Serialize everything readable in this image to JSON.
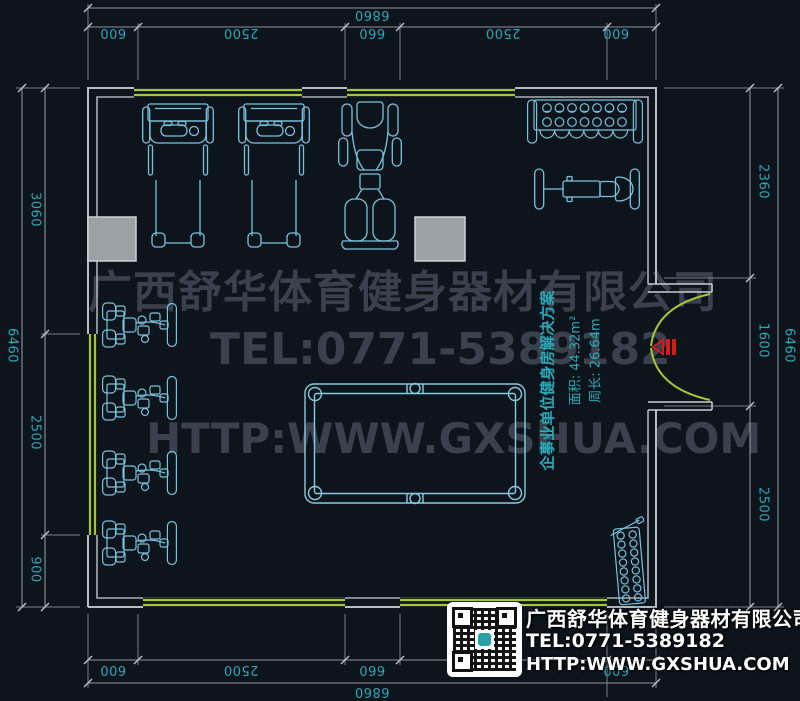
{
  "colors": {
    "background": "#0d141c",
    "wall_line": "#b5bcc2",
    "window_line": "#a3c63a",
    "equipment_line": "#79c2dc",
    "dimension_text": "#2ba8b8",
    "dimension_line": "#8d959b",
    "watermark_text": "#3a414c",
    "door_marker": "#d51a1a",
    "logo_text": "#ffffff"
  },
  "dims": {
    "top": {
      "overall": "6860",
      "segments": [
        "600",
        "2500",
        "660",
        "2500",
        "600"
      ]
    },
    "bottom": {
      "overall": "6860",
      "segments": [
        "600",
        "2500",
        "660",
        "2500",
        "600"
      ]
    },
    "left": {
      "overall": "6460",
      "segments": [
        "3060",
        "2500",
        "900"
      ]
    },
    "right": {
      "overall": "6460",
      "segments": [
        "2360",
        "1600",
        "2500"
      ]
    }
  },
  "annotation": {
    "title": "企事业单位健身房解决方案",
    "area": "面积: 44.32m²",
    "perimeter": "周长: 26.64m"
  },
  "watermark": {
    "company": "广西舒华体育健身器材有限公司",
    "tel": "TEL:0771-5389182",
    "web": "HTTP:WWW.GXSHUA.COM"
  },
  "logo": {
    "company": "广西舒华体育健身器材有限公司",
    "tel": "TEL:0771-5389182",
    "web": "HTTP:WWW.GXSHUA.COM"
  },
  "icons": {
    "equipment": [
      "treadmill",
      "treadmill",
      "multi-station-trainer",
      "dumbbell-rack",
      "weight-bench",
      "strength-machine",
      "strength-machine",
      "strength-machine",
      "strength-machine",
      "billiard-table",
      "plate-rack"
    ],
    "door": "double-swing-door",
    "qr": "qr-code"
  }
}
